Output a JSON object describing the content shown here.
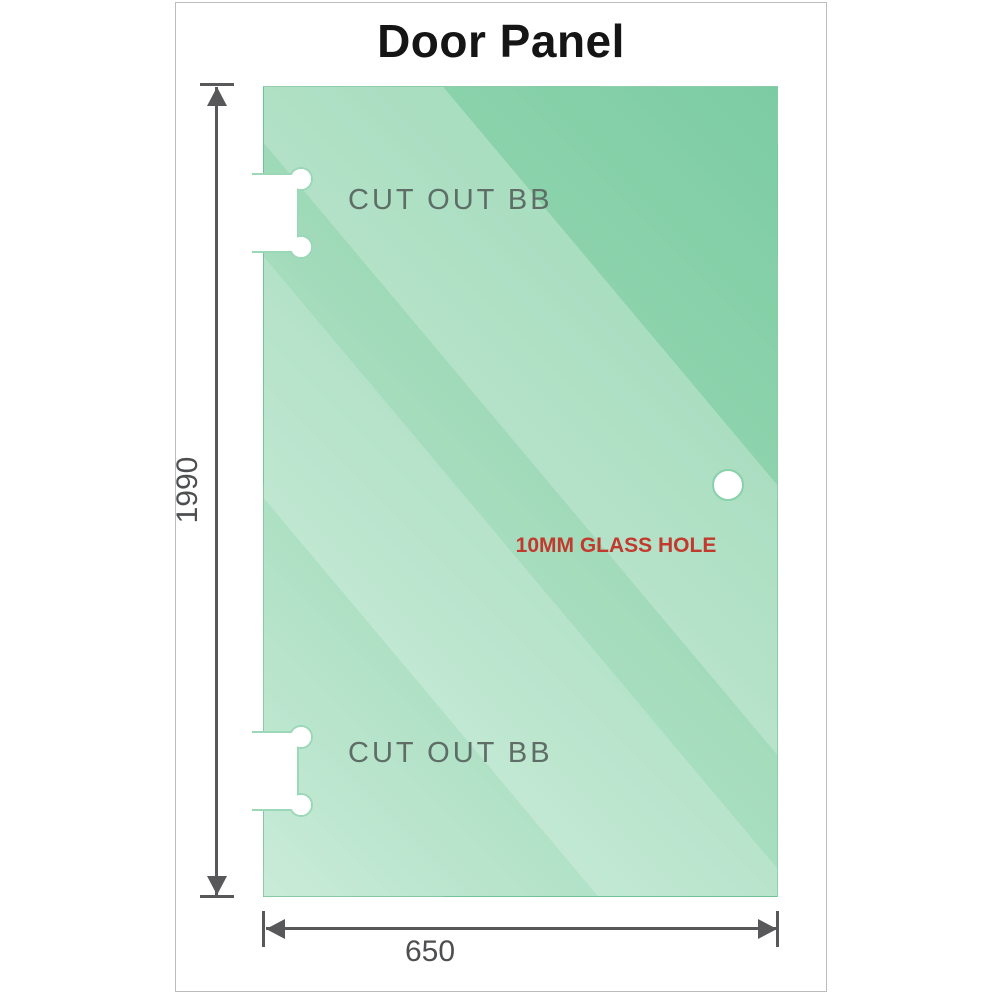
{
  "diagram": {
    "title": "Door Panel",
    "dimensions": {
      "height": "1990",
      "width": "650"
    },
    "cutouts": [
      {
        "label": "CUT OUT BB"
      },
      {
        "label": "CUT OUT BB"
      }
    ],
    "hole": {
      "label": "10MM GLASS HOLE",
      "shape": "circle"
    }
  },
  "colors": {
    "glass_dark": "#7ccca3",
    "glass_light": "#c9ebd8",
    "dimension_line": "#58585a",
    "dimension_value_text": "#4e4f51",
    "cutout_label_text": "#5e6e67",
    "hole_label_text": "#c23a2e",
    "title_text": "#151515",
    "frame_border": "#bcbcbc",
    "cutout_outline": "#9bd8b7"
  }
}
